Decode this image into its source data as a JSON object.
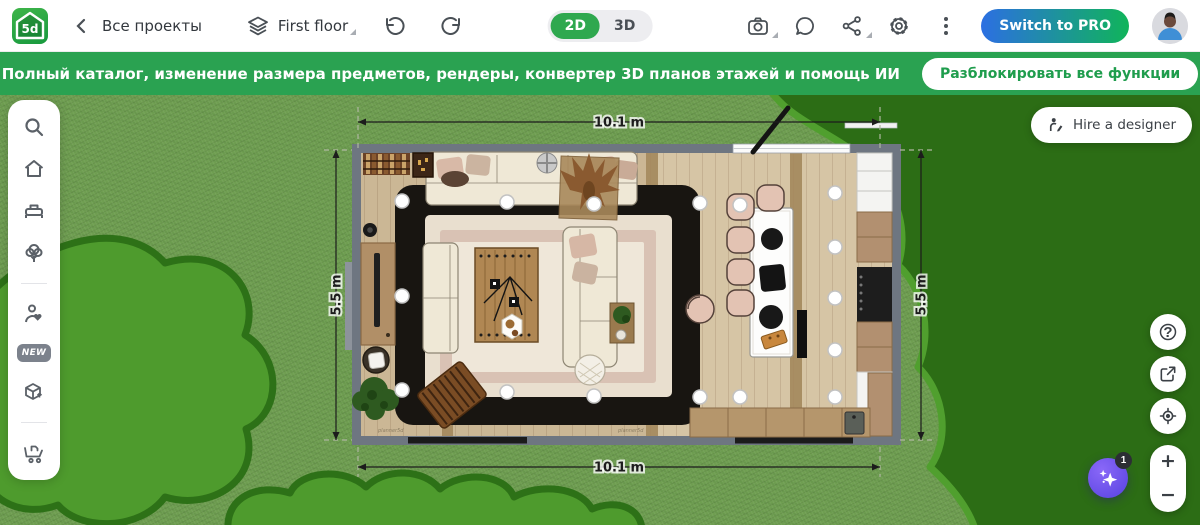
{
  "topbar": {
    "logo_text": "5d",
    "back_label": "Все проекты",
    "floor_label": "First floor",
    "toggle_2d": "2D",
    "toggle_3d": "3D",
    "pro_button": "Switch to PRO"
  },
  "banner": {
    "message": "Полный каталог, изменение размера предметов, рендеры, конвертер 3D планов этажей и помощь ИИ",
    "button": "Разблокировать все функции"
  },
  "sidebar": {
    "new_badge": "NEW"
  },
  "plan": {
    "width_label_top": "10.1 m",
    "width_label_bottom": "10.1 m",
    "height_label_left": "5.5 m",
    "height_label_right": "5.5 m",
    "watermark": "planner5d"
  },
  "floating": {
    "hire_button": "Hire a designer",
    "help": "?",
    "zoom_in": "+",
    "zoom_out": "−",
    "ai_badge": "1"
  },
  "icons": {
    "logo": "5d-house-logo",
    "back": "chevron-left",
    "layers": "layers-stack",
    "undo": "undo-arrow",
    "redo": "redo-arrow",
    "camera": "screenshot-camera",
    "chat": "chat-bubble",
    "share": "share-nodes",
    "settings": "gear",
    "more": "kebab-menu",
    "search": "magnifier",
    "rooms": "home",
    "furniture": "bed",
    "garden": "tree",
    "designer": "person-heart",
    "models": "cube-upload",
    "cart": "shopping-cart",
    "hire": "designer-pencil",
    "help": "question-circle",
    "export": "export-arrow",
    "locate": "crosshair-target",
    "ai": "sparkles",
    "avatar": "user-avatar"
  },
  "colors": {
    "brand_green": "#2fa84f",
    "banner_green": "#2aa251",
    "toggle_active": "#2fa84f",
    "pro_gradient_start": "#2c6fe2",
    "pro_gradient_end": "#10b45a",
    "ai_purple": "#6b4ef2",
    "grass": "#6f9e51",
    "bush_fill": "#4e9b2d",
    "bush_outline": "#2d7117",
    "tree_fill": "#2c6d15",
    "wall_gray": "#6e7681"
  }
}
